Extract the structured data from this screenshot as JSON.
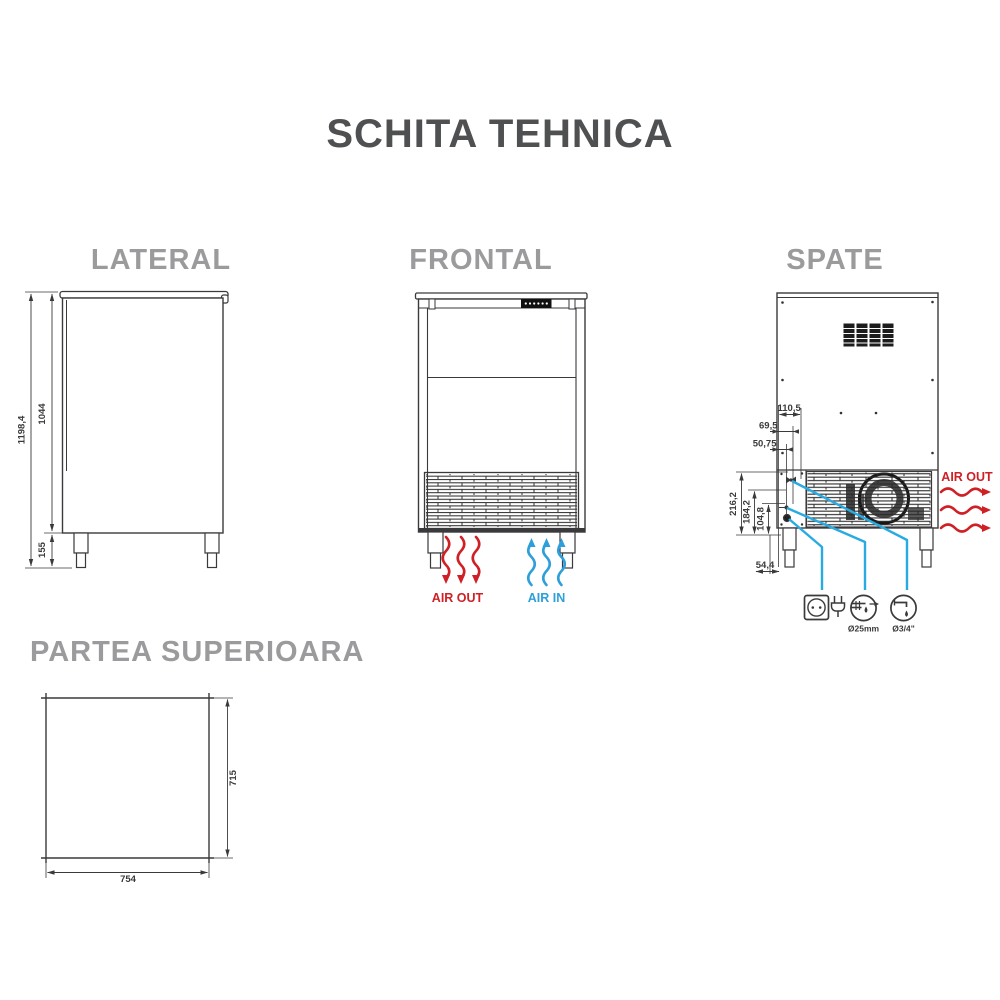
{
  "title": "SCHITA TEHNICA",
  "colors": {
    "title": "#4f5052",
    "heading": "#9b9b9d",
    "line": "#3a3a3c",
    "red": "#cf2026",
    "blue": "#2e9fd9",
    "cyan": "#29abe2"
  },
  "lateral": {
    "label": "LATERAL",
    "dim_total_height": "1198,4",
    "dim_body_height": "1044",
    "dim_leg_height": "155"
  },
  "frontal": {
    "label": "FRONTAL",
    "air_out_label": "AIR OUT",
    "air_in_label": "AIR IN"
  },
  "spate": {
    "label": "SPATE",
    "air_out_label": "AIR OUT",
    "dim_offset_1": "110,5",
    "dim_offset_2": "69,5",
    "dim_offset_3": "50,75",
    "dim_height_1": "216,2",
    "dim_height_2": "184,2",
    "dim_height_3": "104,8",
    "dim_bottom": "54,4",
    "water_inlet_label": "Ø25mm",
    "drain_label": "Ø3/4\""
  },
  "top": {
    "label": "PARTEA SUPERIOARA",
    "dim_width": "754",
    "dim_depth": "715"
  }
}
